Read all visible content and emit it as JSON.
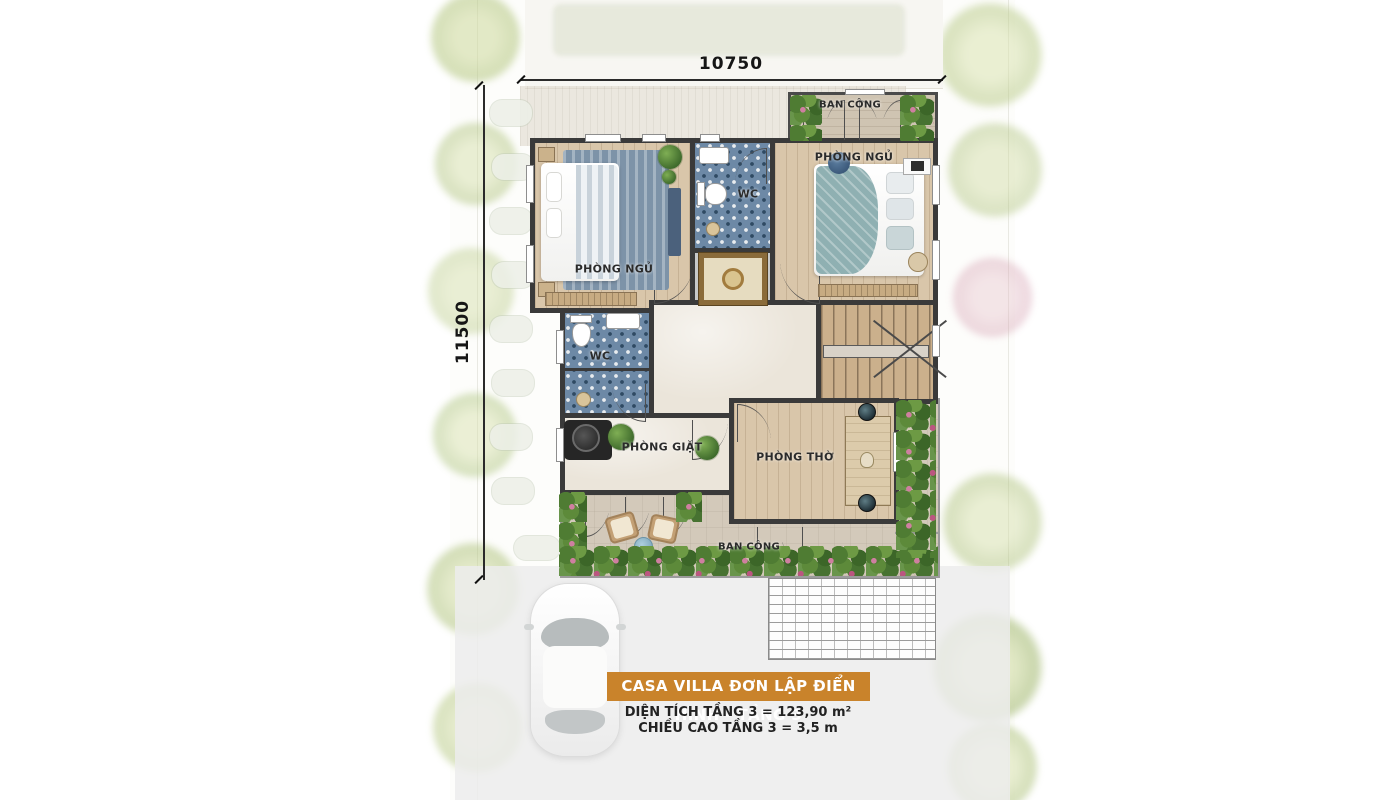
{
  "plan": {
    "dimensions": {
      "width": "10750",
      "height": "11500"
    },
    "rooms": {
      "balcony_top": "BAN CÔNG",
      "bedroom_left": "PHÒNG NGỦ",
      "bedroom_right": "PHÒNG NGỦ",
      "wc_top": "WC",
      "wc_side": "WC",
      "laundry": "PHÒNG GIẶT",
      "worship": "PHÒNG THỜ",
      "balcony_bottom": "BAN CÔNG"
    }
  },
  "caption": {
    "title": "CASA VILLA ĐƠN LẬP ĐIỂN HÌNH - TẦNG 3",
    "area": "DIỆN TÍCH TẦNG 3 = 123,90 m²",
    "height": "CHIỀU CAO TẦNG 3 = 3,5 m"
  },
  "colors": {
    "banner_orange": "#C9832B",
    "wall_dark": "#3A3A3A",
    "wood_floor": "#D9C6AA",
    "blue_tile": "#6D89A6",
    "greenery": "#4F7C33",
    "terrace": "#D3C9BA"
  }
}
